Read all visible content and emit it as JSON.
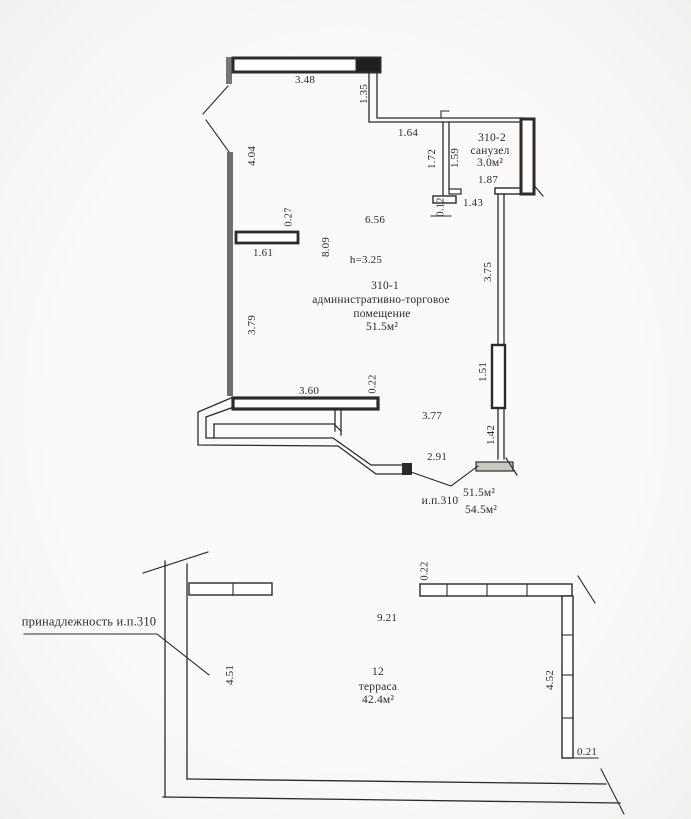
{
  "colors": {
    "ink": "#2b2b2b",
    "wall_gray": "#6e6e6e",
    "paper": "#fbfaf8"
  },
  "upper_plan": {
    "main_room": {
      "number": "310-1",
      "name_line1": "административно-торговое",
      "name_line2": "помещение",
      "area": "51.5м²",
      "height_mark": "h=3.25"
    },
    "wc_room": {
      "number": "310-2",
      "name": "санузел",
      "area": "3.0м²"
    },
    "dims": {
      "d348": "3.48",
      "d135": "1.35",
      "d164": "1.64",
      "d172": "1.72",
      "d159": "1.59",
      "d187": "1.87",
      "d012": "0.12",
      "d143": "1.43",
      "d404": "4.04",
      "d027": "0.27",
      "d161": "1.61",
      "d656": "6.56",
      "d809": "8.09",
      "d379": "3.79",
      "d375": "3.75",
      "d151": "1.51",
      "d142": "1.42",
      "d360": "3.60",
      "d022": "0.22",
      "d377": "3.77",
      "d291": "2.91"
    },
    "callout": {
      "label": "и.п.310",
      "area_top": "51.5м²",
      "area_bottom": "54.5м²"
    }
  },
  "lower_plan": {
    "room": {
      "number": "12",
      "name": "терраса",
      "area": "42.4м²"
    },
    "ownership_note": "принадлежность и.п.310",
    "dims": {
      "d022": "0.22",
      "d921": "9.21",
      "d451": "4.51",
      "d452": "4.52",
      "d021": "0.21"
    }
  }
}
